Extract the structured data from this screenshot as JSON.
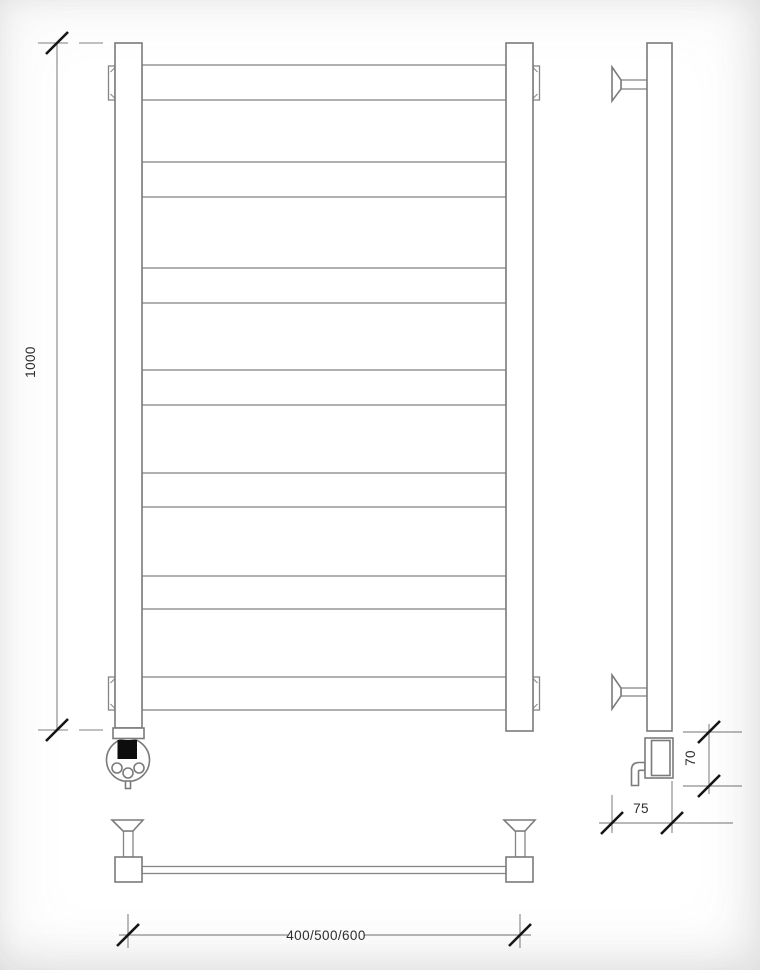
{
  "dimensions": {
    "height_mm": "1000",
    "widths_mm": "400/500/600",
    "wall_depth_mm": "75",
    "element_height_mm": "70"
  },
  "structure": {
    "rung_count": 7,
    "post_count": 2,
    "wall_bracket_count": 4,
    "has_heating_element": true
  },
  "colors": {
    "background": "#ffffff",
    "line": "#7b7b7b",
    "dimension_line": "#8f8f8f",
    "tick_mark": "#161616",
    "label_text": "#2e2e2e",
    "element_plug": "#0d0d0d"
  }
}
